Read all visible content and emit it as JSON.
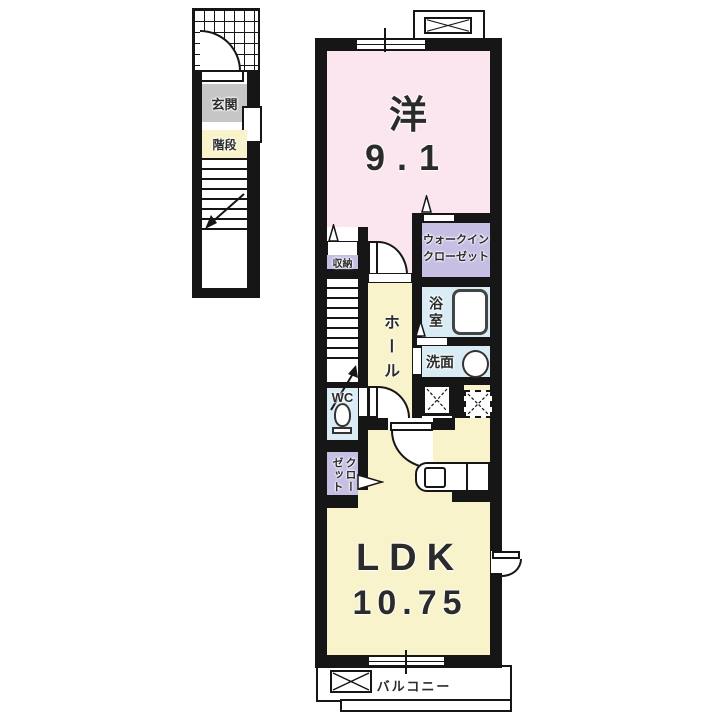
{
  "colors": {
    "wall": "#161616",
    "room_pink": "#fbe5ef",
    "room_yellow": "#f8f3ca",
    "room_blue": "#d9ecf5",
    "room_purple": "#c6bee3",
    "room_gray": "#c6c6c6",
    "fixture_line": "#444444"
  },
  "labels": {
    "genkan": "玄関",
    "kaidan": "階段",
    "western_name": "洋",
    "western_size": "9.1",
    "wic1": "ウォークイン",
    "wic2": "クローゼット",
    "storage": "収納",
    "hall": "ホール",
    "bath": "浴室",
    "washroom": "洗面",
    "wc": "WC",
    "closet": "クローゼット",
    "ldk_name": "LDK",
    "ldk_size": "10.75",
    "balcony": "バルコニー"
  },
  "icons": {
    "porch": "grid-hatch-icon",
    "entry_door": "door-arc-icon",
    "room_door": "door-arc-icon",
    "wc_door": "door-arc-icon",
    "ldk_door": "door-arc-icon",
    "exterior_door": "door-arc-icon",
    "ac_pad_top": "x-box-icon",
    "ac_pad_balcony": "x-box-icon",
    "washer_space": "x-box-icon",
    "fridge_space": "dashed-x-box-icon",
    "bathtub": "bathtub-icon",
    "toilet": "toilet-icon",
    "sink": "sink-oval-icon",
    "kitchen": "kitchen-counter-icon",
    "stairs": "stairs-arrow-icon",
    "vent": "triangle-vent-icon",
    "folding_door": "triangle-door-icon",
    "window": "sliding-window-icon"
  }
}
